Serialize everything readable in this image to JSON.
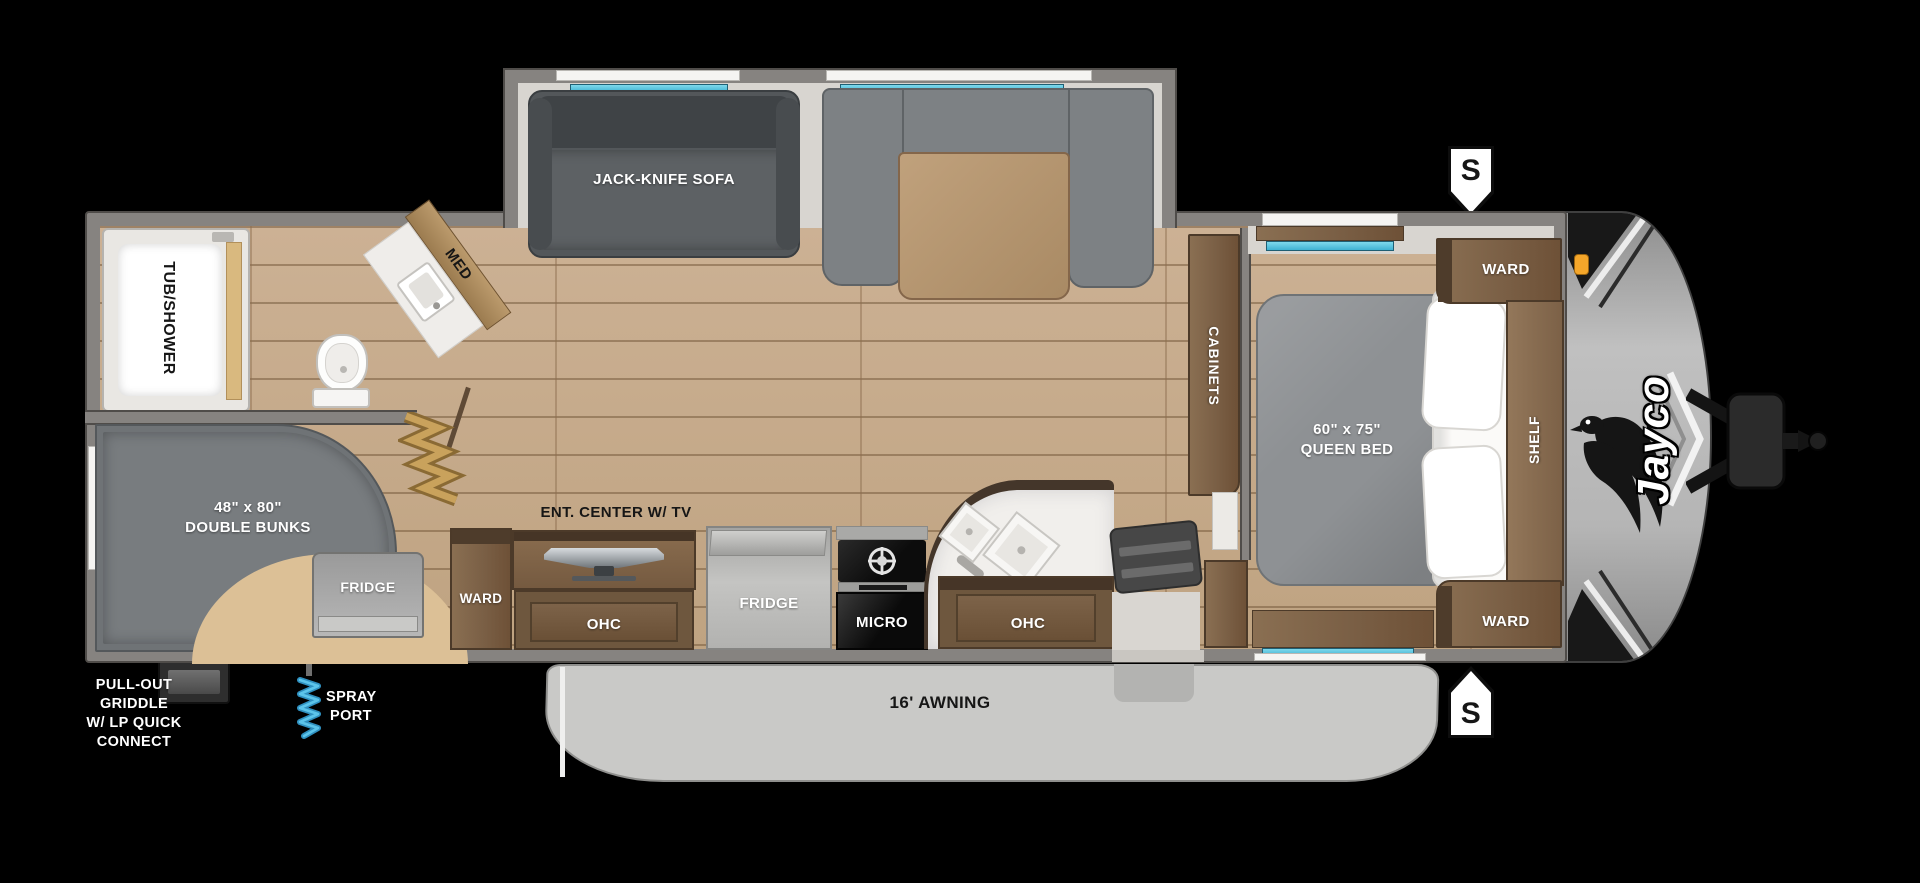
{
  "brand": {
    "logo": "Jayco"
  },
  "badges": {
    "speaker": "S"
  },
  "slideout": {
    "sofa": "JACK-KNIFE SOFA"
  },
  "bathroom": {
    "tub": "TUB/SHOWER",
    "med": "MED"
  },
  "bunkroom": {
    "size": "48\" x 80\"",
    "name": "DOUBLE BUNKS",
    "fridge": "FRIDGE"
  },
  "living": {
    "ward": "WARD",
    "ent_center": "ENT. CENTER W/ TV",
    "ohc": "OHC"
  },
  "kitchen": {
    "fridge": "FRIDGE",
    "micro": "MICRO",
    "ohc": "OHC"
  },
  "bedroom": {
    "cabinets": "CABINETS",
    "bed_size": "60\" x 75\"",
    "bed_name": "QUEEN BED",
    "ward_top": "WARD",
    "shelf": "SHELF",
    "ward_bottom": "WARD"
  },
  "exterior": {
    "awning": "16' AWNING",
    "griddle_lines": [
      "PULL-OUT",
      "GRIDDLE",
      "W/ LP QUICK",
      "CONNECT"
    ],
    "spray_lines": [
      "SPRAY",
      "PORT"
    ]
  },
  "colors": {
    "floor_wood": "#c7ab8d",
    "cabinet_wood": "#7c6147",
    "wall": "#868380",
    "awning": "#c9c9c7",
    "window_teal": "#56c5dd",
    "accordion_gold": "#c09a55",
    "marker_orange": "#f4a62a",
    "fabric_gray": "#6f7376"
  }
}
